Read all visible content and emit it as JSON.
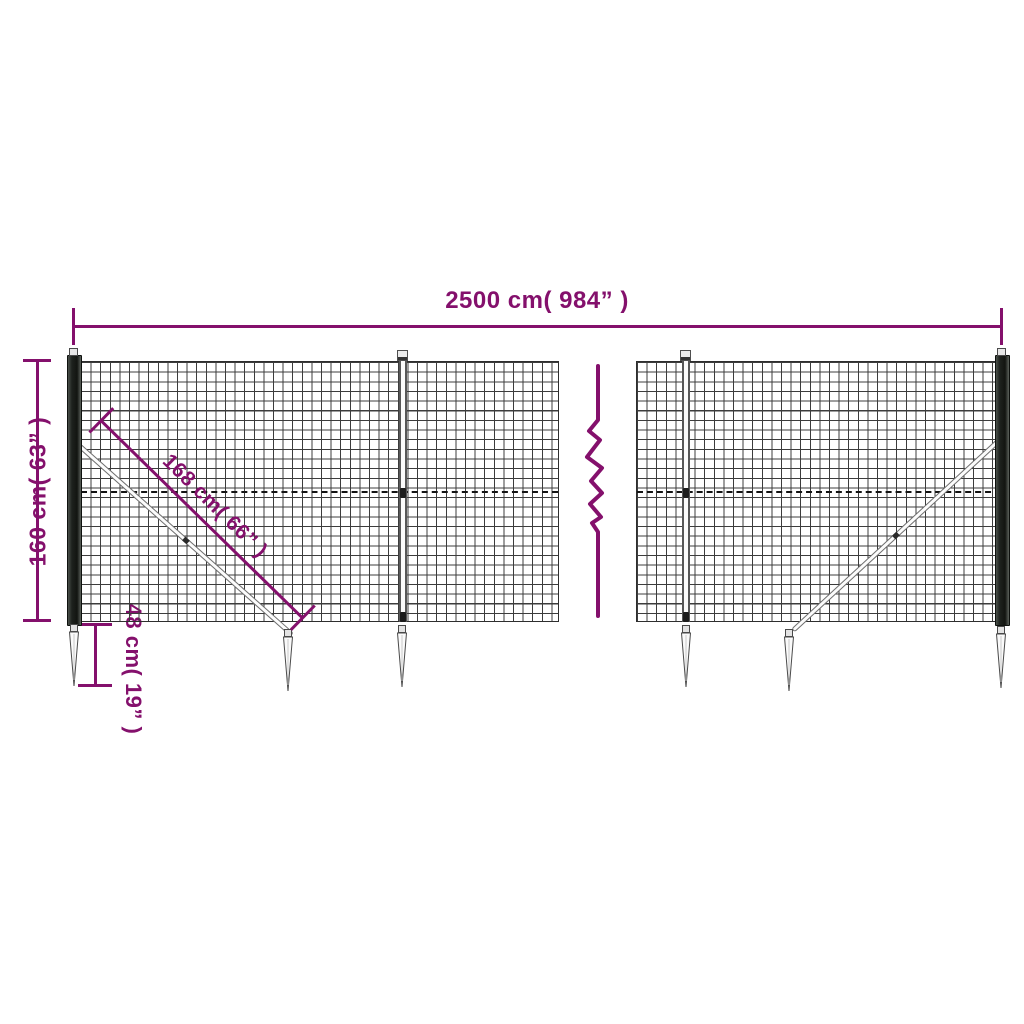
{
  "diagram": {
    "colors": {
      "accent": "#84106c",
      "mesh": "#3c3c3c",
      "post": "#1d211d",
      "hardware": "#6f6f6f"
    },
    "dimensions": {
      "total_width_label": "2500 cm( 984” )",
      "height_label": "160 cm( 63” )",
      "brace_label": "168 cm( 66” )",
      "spike_label": "48 cm( 19” )"
    }
  }
}
